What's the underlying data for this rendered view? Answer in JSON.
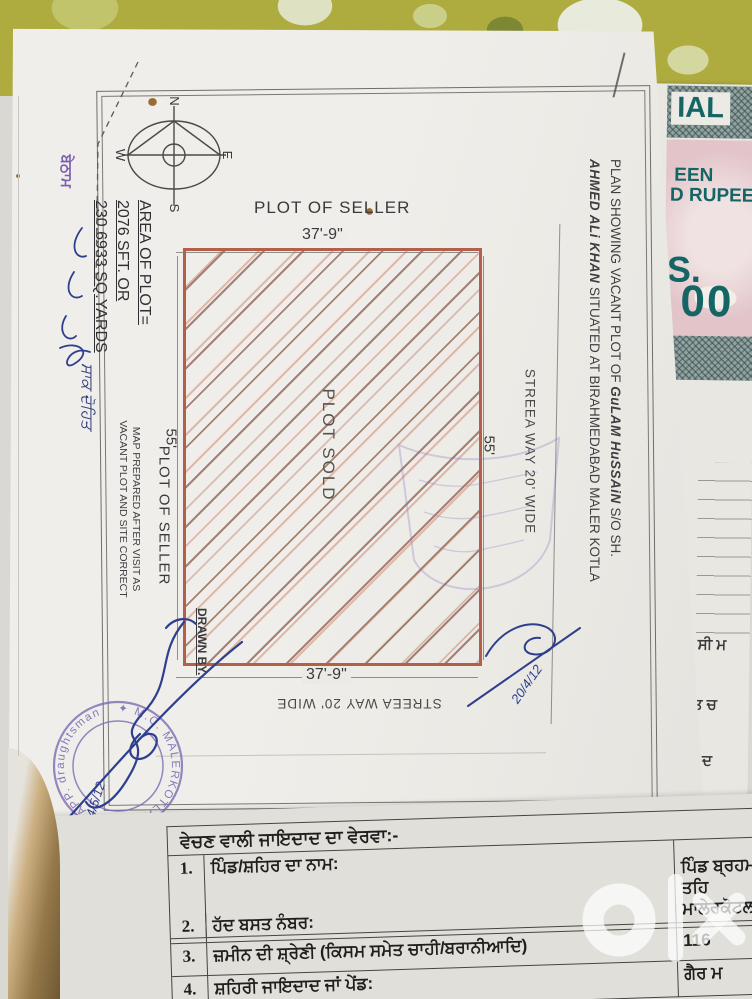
{
  "map": {
    "compass": {
      "n": "N",
      "e": "E",
      "s": "S",
      "w": "W"
    },
    "top_plot_label": "PLOT OF SELLER",
    "top_dim": "37'-9\"",
    "bottom_dim": "37'-9\"",
    "left_dim": "55'",
    "right_dim": "55'",
    "plot_sold": "PLOT SOLD",
    "left_plot_label": "PLOT OF SELLER",
    "street_right": "STREEA  WAY 20' WIDE",
    "street_bottom": "STREEA  WAY  20' WIDE",
    "area_lines": [
      "AREA OF PLOT=",
      "2076 SFT. OR",
      "230.6933 SQ.YARDS"
    ],
    "note_line1": "MAP PREPARED AFTER VISIT AS",
    "note_line2": "VACANT PLOT AND SITE CORRECT",
    "drawn_by": "DRAWN BY.",
    "title_pre1": "PLAN  SHOWING  VACANT  PLOT  OF ",
    "title_name1": "GuLAM  HuSSAiN",
    "title_post1": " S/O  SH.",
    "title_name2": "AHMED  ALi  KHAN",
    "title_post2": " SITUATED  AT  BIRAHMEDABAD  MALER  KOTLA",
    "stamp_ring_text": "✦ M.C. MALERKOTLA ✦ M. R. APP. draughtsman",
    "signature_date_1": "24/5/12",
    "signature_date_2": "20/4/12",
    "margin_stamp": "ਬੇਠਾਮ",
    "margin_handwriting": "ਸਾਕ ਦੋਹਿਤ"
  },
  "stamp_paper": {
    "frag_1": "IAL",
    "frag_2": "EEN",
    "frag_3": "D RUPEE",
    "frag_4": "S.",
    "frag_5": "00"
  },
  "side_page": {
    "frag_1": "ਸੀ ਮ",
    "frag_2": "ਤ ਚ",
    "frag_3": "ਦ"
  },
  "table": {
    "header": "ਵੇਚਣ ਵਾਲੀ ਜਾਇਦਾਦ ਦਾ ਵੇਰਵਾ:-",
    "rows": [
      {
        "num": "1.",
        "label": "ਪਿੰਡ/ਸ਼ਹਿਰ ਦਾ ਨਾਮ:",
        "value_line1": "ਪਿੰਡ ਬ੍ਰਹਮਦਾਬਾਦ ਤਹਿ",
        "value_line2": "ਮਾਲੇਰਕੋਟਲਾ"
      },
      {
        "num": "2.",
        "label": "ਹੱਦ ਬਸਤ ਨੰਬਰ:",
        "value": ""
      },
      {
        "num": "3.",
        "label": "ਜ਼ਮੀਨ ਦੀ ਸ਼੍ਰੇਣੀ (ਕਿਸਮ ਸਮੇਤ ਚਾਹੀ/ਬਰਾਨੀਆਦਿ)",
        "value": "116"
      },
      {
        "num": "4.",
        "label": "ਸ਼ਹਿਰੀ ਜਾਇਦਾਦ ਜਾਂ ਪੇਂਡ:",
        "value": "ਗੈਰ ਮ"
      }
    ]
  },
  "watermark": {
    "brand": "olx"
  },
  "colors": {
    "plot_border": "#b35f49",
    "stamp_purple": "#7e6cb4",
    "ink_blue": "#2e3f8e",
    "stamp_teal": "#156565",
    "stamp_pink": "#e2c4c9",
    "cloth_olive": "#aeab3f"
  }
}
